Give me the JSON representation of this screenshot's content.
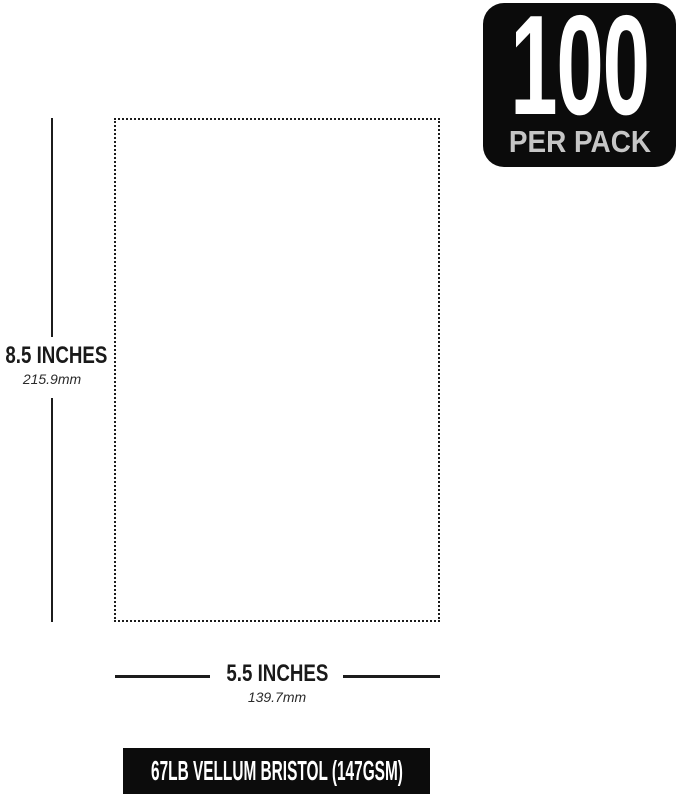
{
  "badge": {
    "count": "100",
    "subtitle": "PER PACK"
  },
  "height_dim": {
    "inches": "8.5 INCHES",
    "mm": "215.9mm"
  },
  "width_dim": {
    "inches": "5.5 INCHES",
    "mm": "139.7mm"
  },
  "footer": {
    "label": "67LB VELLUM BRISTOL (147GSM)"
  },
  "colors": {
    "badge_bg": "#0b0b0b",
    "badge_subtitle": "#c6c6c6",
    "line": "#1c1c1c",
    "footer_bg": "#0c0c0c",
    "text": "#1a1a1a",
    "bg": "#ffffff"
  }
}
